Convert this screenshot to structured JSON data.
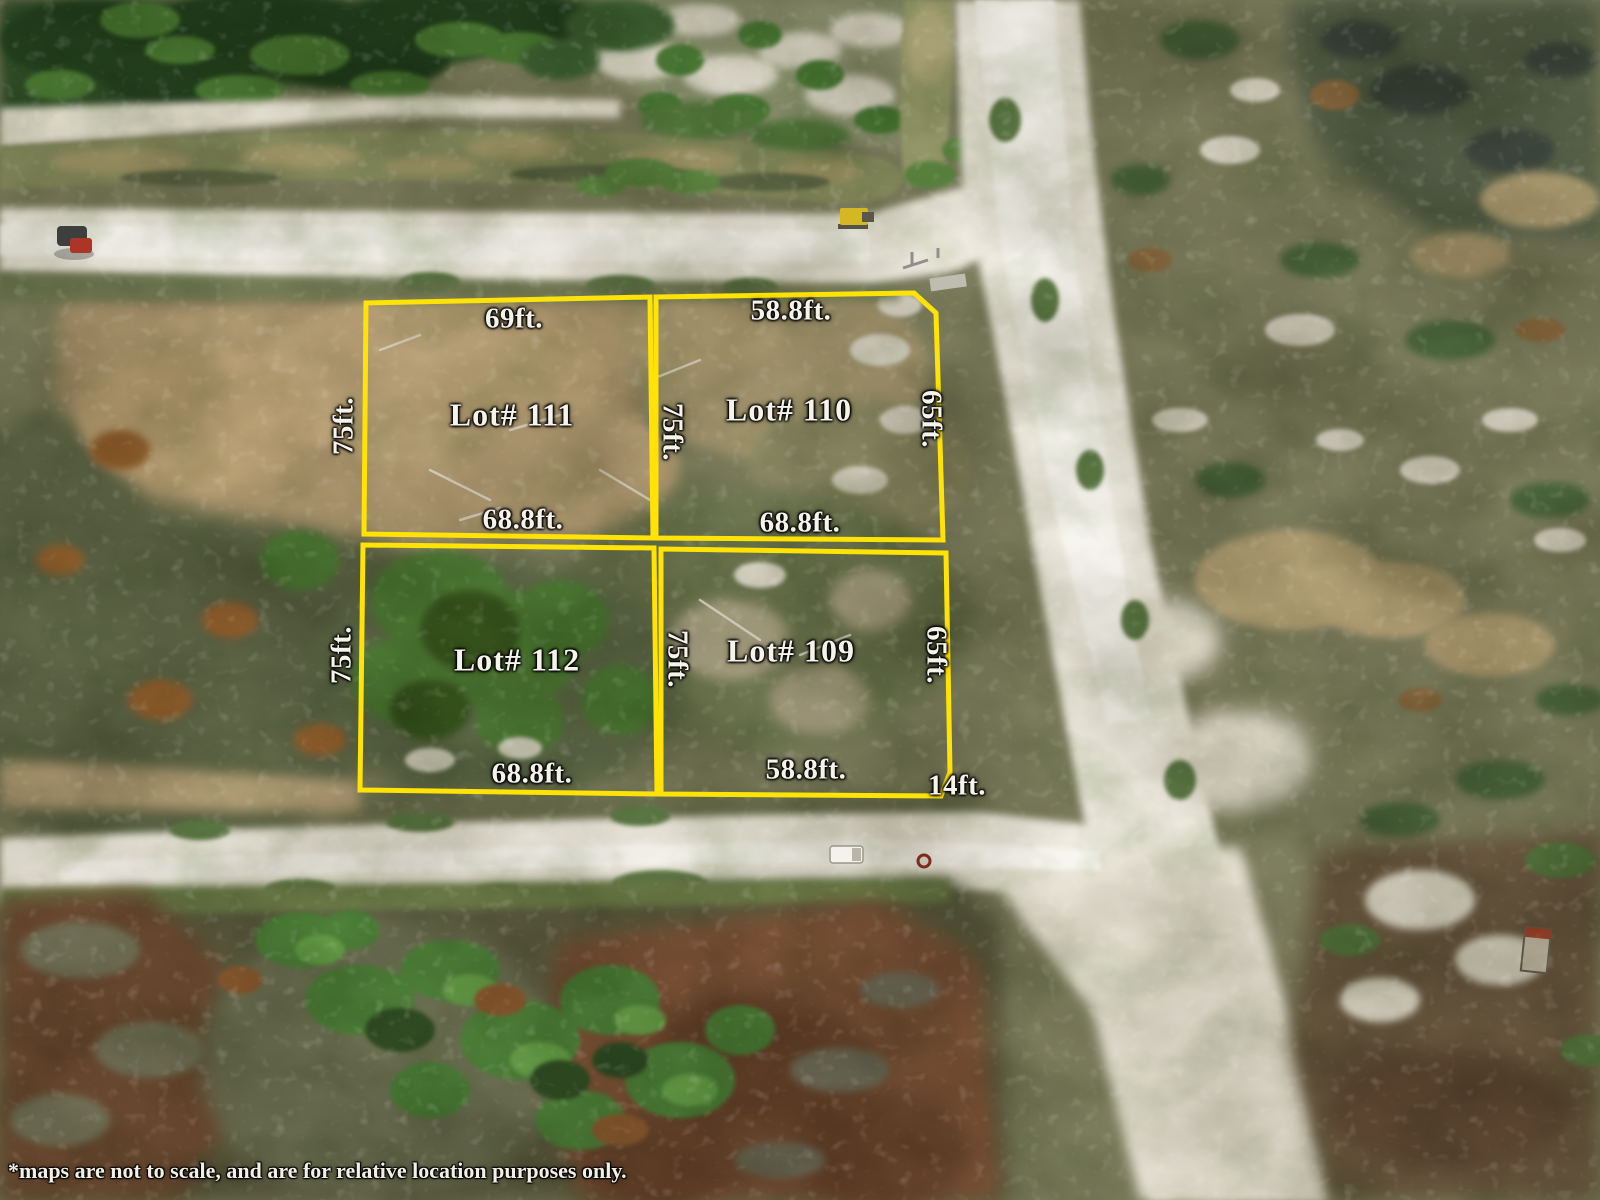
{
  "map": {
    "disclaimer": "*maps are not to scale, and are for relative location purposes only.",
    "boundary_color": "#FFE206",
    "label_color": "#F5F3EA"
  },
  "lot_names": {
    "lot111": "Lot# 111",
    "lot110": "Lot# 110",
    "lot112": "Lot# 112",
    "lot109": "Lot# 109"
  },
  "dimensions": {
    "lot111_top": "69ft.",
    "lot110_top": "58.8ft.",
    "lot111_left": "75ft.",
    "mid_upper": "75ft.",
    "lot110_right": "65ft.",
    "lot111_bottom": "68.8ft.",
    "lot110_bottom": "68.8ft.",
    "lot112_left": "75ft.",
    "mid_lower": "75ft.",
    "lot109_right": "65ft.",
    "lot112_bottom": "68.8ft.",
    "lot109_bottom": "58.8ft.",
    "corner": "14ft."
  }
}
